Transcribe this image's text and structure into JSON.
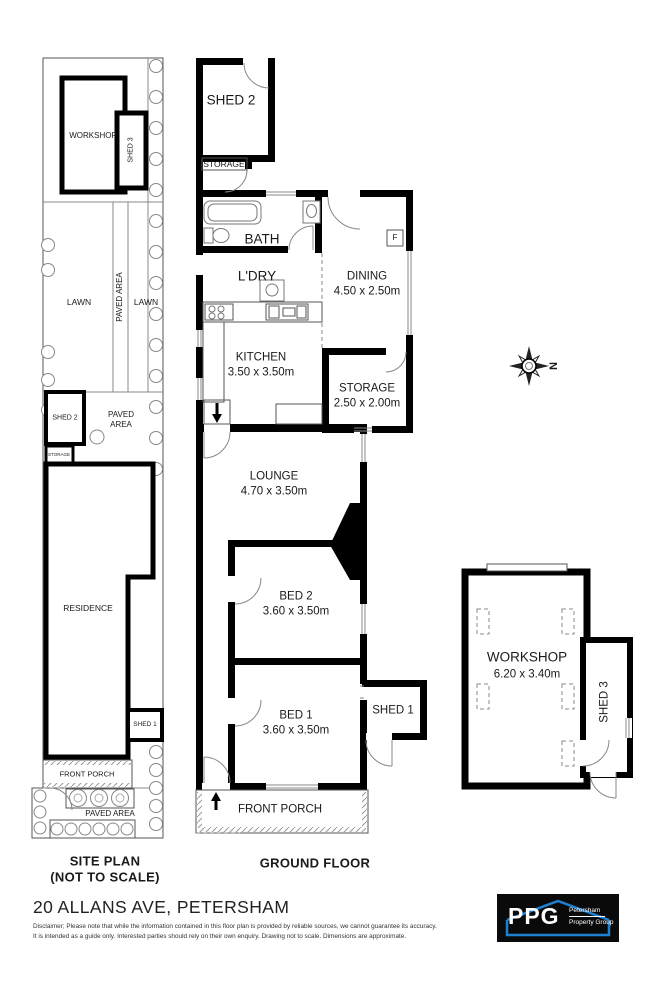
{
  "site_plan": {
    "title": "SITE PLAN",
    "subtitle": "(NOT TO SCALE)",
    "labels": {
      "workshop": "WORKSHOP",
      "shed3": "SHED 3",
      "lawn_left": "LAWN",
      "paved_strip": "PAVED AREA",
      "lawn_right": "LAWN",
      "shed2": "SHED 2",
      "storage": "STORAGE",
      "paved_line1": "PAVED",
      "paved_line2": "AREA",
      "residence": "RESIDENCE",
      "shed1": "SHED 1",
      "front_porch": "FRONT PORCH",
      "paved_bottom": "PAVED AREA"
    }
  },
  "ground_floor": {
    "title": "GROUND FLOOR",
    "rooms": {
      "shed2": {
        "name": "SHED 2"
      },
      "storage_top": {
        "name": "STORAGE"
      },
      "bath": {
        "name": "BATH"
      },
      "laundry": {
        "name": "L'DRY"
      },
      "dining": {
        "name": "DINING",
        "dims": "4.50 x 2.50m"
      },
      "kitchen": {
        "name": "KITCHEN",
        "dims": "3.50 x 3.50m"
      },
      "storage": {
        "name": "STORAGE",
        "dims": "2.50 x 2.00m"
      },
      "lounge": {
        "name": "LOUNGE",
        "dims": "4.70 x 3.50m"
      },
      "bed2": {
        "name": "BED 2",
        "dims": "3.60 x 3.50m"
      },
      "bed1": {
        "name": "BED 1",
        "dims": "3.60 x 3.50m"
      },
      "shed1": {
        "name": "SHED 1"
      },
      "front_porch": {
        "name": "FRONT PORCH"
      }
    },
    "fridge_label": "F"
  },
  "outbuildings": {
    "workshop": {
      "name": "WORKSHOP",
      "dims": "6.20 x 3.40m"
    },
    "shed3": {
      "name": "SHED 3"
    }
  },
  "compass": {
    "north_label": "N"
  },
  "footer": {
    "address": "20 ALLANS AVE, PETERSHAM",
    "disclaimer_line1": "Disclaimer; Please note that while the information contained in this floor plan is provided by reliable sources, we cannot guarantee its accuracy.",
    "disclaimer_line2": "It is intended as a guide only. Interested parties should rely on their own enquiry. Drawing not to scale.  Dimensions are approximate.",
    "logo": {
      "acronym": "PPG",
      "line1": "Petersham",
      "line2": "Property Group",
      "accent_color": "#1f80d0",
      "bg_color": "#0a0a0a"
    }
  },
  "colors": {
    "wall": "#000000",
    "background": "#ffffff"
  }
}
